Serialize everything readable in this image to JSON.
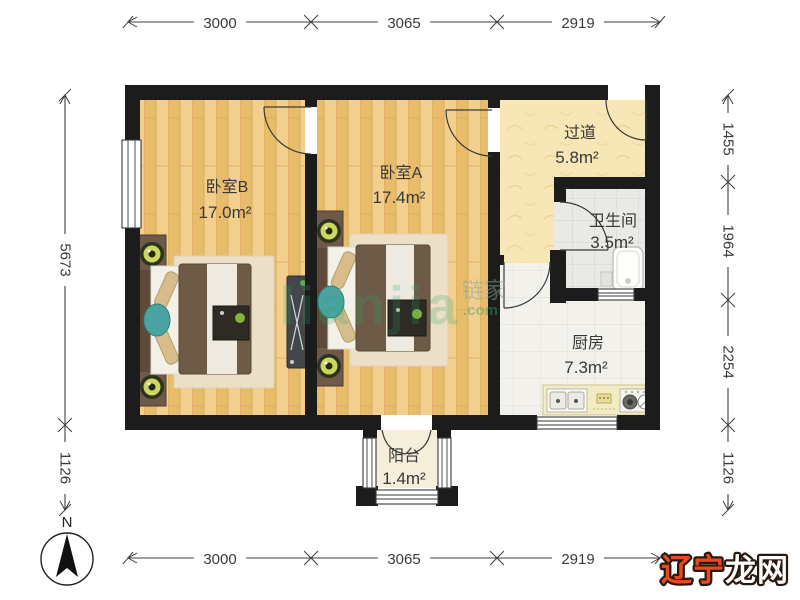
{
  "rooms": [
    {
      "id": "bedroom_b",
      "name": "卧室B",
      "area": "17.0m²"
    },
    {
      "id": "bedroom_a",
      "name": "卧室A",
      "area": "17.4m²"
    },
    {
      "id": "hallway",
      "name": "过道",
      "area": "5.8m²"
    },
    {
      "id": "bathroom",
      "name": "卫生间",
      "area": "3.5m²"
    },
    {
      "id": "kitchen",
      "name": "厨房",
      "area": "7.3m²"
    },
    {
      "id": "balcony",
      "name": "阳台",
      "area": "1.4m²"
    }
  ],
  "dimensions_mm": {
    "top": [
      "3000",
      "3065",
      "2919"
    ],
    "bottom": [
      "3000",
      "3065",
      "2919"
    ],
    "left": [
      "5673",
      "1126"
    ],
    "right": [
      "1455",
      "1964",
      "2254",
      "1126"
    ]
  },
  "compass": {
    "label": "N"
  },
  "watermarks": {
    "center_latin": "lianjia",
    "center_cn": "链家",
    "center_domain": ".com",
    "corner_red": "辽宁",
    "corner_white": "龙网"
  },
  "colors": {
    "wall": "#1c1c1c",
    "wood_floor": "#eec77d",
    "hallway_floor": "#f7e6b6",
    "bathroom_floor": "#e9e9e5",
    "kitchen_floor": "#f2f1ec",
    "balcony_floor": "#f5eedb",
    "watermark_green": "#2fa36b",
    "corner_red": "#e8491f"
  }
}
